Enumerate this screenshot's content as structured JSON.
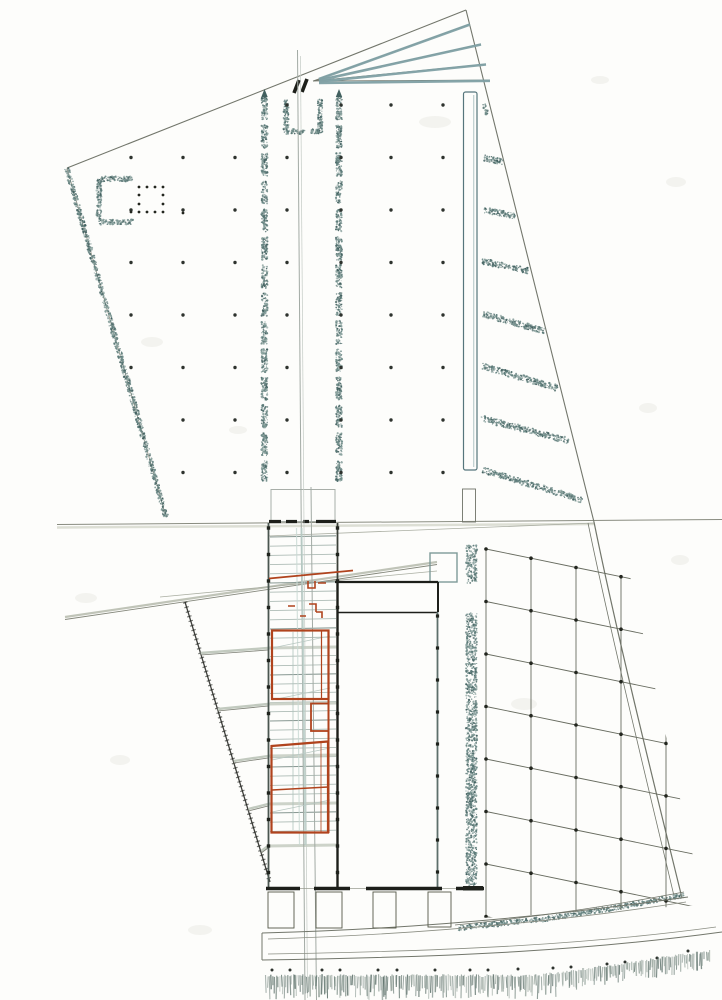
{
  "document": {
    "type": "scanned architectural site plan drawing",
    "description": "Hand-drafted master plan: upper trapezoidal plaza with column grid and twin tree rows, entry fan at top, central stair-ramp spine with red-outlined building rooms, dark exhibition hall, curvilinear orchard grid at lower right, waterfront promenade with reed fringe at bottom",
    "visible_text": []
  },
  "palette": {
    "paper": "#fdfdfb",
    "ink": "#72766b",
    "black": "#1d1f1a",
    "teal_dark": "#42605f",
    "teal_mid": "#6f8c89",
    "teal_light": "#9db7b7",
    "brick_red": "#b0431d",
    "road_gray": "#c0c4b8",
    "rung_light": "#aebcb6",
    "rung_dark": "#8a9a94",
    "fringe_green": "#70827c",
    "blotch": "#ebebe5"
  },
  "drawing": {
    "canvas": {
      "w": 722,
      "h": 1000
    },
    "stipple_colors": [
      "#42605f",
      "#597876",
      "#6f8c89",
      "#8da4a0"
    ],
    "stipple_strips": [
      {
        "name": "boundary-left-hatch",
        "x1": 67,
        "y1": 168,
        "x2": 166,
        "y2": 517,
        "w": 5,
        "d": 0.5,
        "seg": 0,
        "gap": 0
      },
      {
        "name": "tree-row-left",
        "x1": 264.5,
        "y1": 97,
        "x2": 264.5,
        "y2": 481,
        "w": 6,
        "d": 0.55,
        "seg": 23,
        "gap": 5
      },
      {
        "name": "tree-row-right",
        "x1": 339,
        "y1": 97,
        "x2": 339,
        "y2": 481,
        "w": 6,
        "d": 0.55,
        "seg": 23,
        "gap": 5
      },
      {
        "name": "gate-left-post",
        "x1": 286,
        "y1": 99,
        "x2": 286,
        "y2": 133,
        "w": 5,
        "d": 0.6,
        "seg": 0,
        "gap": 0
      },
      {
        "name": "gate-left-foot",
        "x1": 286,
        "y1": 131.5,
        "x2": 305,
        "y2": 131.5,
        "w": 5,
        "d": 0.6,
        "seg": 0,
        "gap": 0
      },
      {
        "name": "gate-right-post",
        "x1": 320,
        "y1": 99,
        "x2": 320,
        "y2": 133,
        "w": 5,
        "d": 0.6,
        "seg": 0,
        "gap": 0
      },
      {
        "name": "gate-right-foot",
        "x1": 311,
        "y1": 131.5,
        "x2": 320,
        "y2": 131.5,
        "w": 5,
        "d": 0.6,
        "seg": 0,
        "gap": 0
      },
      {
        "name": "c-pavilion-top",
        "x1": 99,
        "y1": 179,
        "x2": 133,
        "y2": 179,
        "w": 5,
        "d": 0.6,
        "seg": 0,
        "gap": 0
      },
      {
        "name": "c-pavilion-left",
        "x1": 99,
        "y1": 179,
        "x2": 99,
        "y2": 222,
        "w": 5,
        "d": 0.6,
        "seg": 0,
        "gap": 0
      },
      {
        "name": "c-pavilion-bottom",
        "x1": 99,
        "y1": 222,
        "x2": 133,
        "y2": 222,
        "w": 5,
        "d": 0.6,
        "seg": 0,
        "gap": 0
      },
      {
        "name": "service-strip-upper",
        "x1": 471.5,
        "y1": 545,
        "x2": 471.5,
        "y2": 583,
        "w": 11,
        "d": 0.4,
        "seg": 0,
        "gap": 0
      },
      {
        "name": "service-strip-lower",
        "x1": 471.5,
        "y1": 613,
        "x2": 471.5,
        "y2": 886,
        "w": 11,
        "d": 0.4,
        "seg": 0,
        "gap": 0
      },
      {
        "name": "sweep-band-1",
        "x1": 458,
        "y1": 928,
        "x2": 545,
        "y2": 919,
        "w": 5,
        "d": 0.5,
        "seg": 0,
        "gap": 0
      },
      {
        "name": "sweep-band-2",
        "x1": 545,
        "y1": 919,
        "x2": 620,
        "y2": 907,
        "w": 5,
        "d": 0.5,
        "seg": 0,
        "gap": 0
      },
      {
        "name": "sweep-band-3",
        "x1": 620,
        "y1": 907,
        "x2": 684,
        "y2": 895,
        "w": 5,
        "d": 0.5,
        "seg": 0,
        "gap": 0
      },
      {
        "name": "hedge-mini",
        "x1": 484,
        "y1": 104,
        "x2": 487,
        "y2": 114,
        "w": 3,
        "d": 0.7,
        "seg": 0,
        "gap": 0
      }
    ],
    "hedge_bars": [
      [
        484,
        158,
        503,
        162
      ],
      [
        484,
        210,
        515,
        216
      ],
      [
        482,
        261,
        529,
        271
      ],
      [
        483,
        314,
        544,
        331
      ],
      [
        482,
        366,
        557,
        388
      ],
      [
        481,
        418,
        569,
        441
      ],
      [
        483,
        470,
        582,
        500
      ]
    ],
    "hedge_bar_w": 6,
    "column_grid": {
      "cols": [
        131,
        183,
        235,
        287,
        341,
        391,
        443
      ],
      "rows": [
        105,
        157.5,
        210,
        262.5,
        315,
        367.5,
        420,
        472.5
      ],
      "skip": [
        "131,105",
        "183,105",
        "235,105",
        "131,420",
        "131,472.5"
      ],
      "r": 1.7
    },
    "pavilion_dots": {
      "xs": [
        139,
        147,
        155,
        163
      ],
      "ys": [
        187,
        195,
        204,
        212
      ],
      "omit_inner": true,
      "extra": [
        [
          131,
          212
        ],
        [
          183,
          213
        ]
      ],
      "r": 1.4
    },
    "band": {
      "x1": 270,
      "x2": 336,
      "rung_y1": 537,
      "rung_y2": 836,
      "step": 9.2,
      "dark_every": 5
    },
    "cross_bands": [
      648,
      704,
      756,
      804,
      846
    ],
    "rays": {
      "band_x": 268,
      "ys": [
        648,
        704,
        756,
        804,
        846
      ],
      "edge_x0": 185,
      "edge_y0": 602,
      "edge_slope": 0.306,
      "drop": 5
    },
    "wall_ticks": [
      {
        "xs": [
          268.5,
          337.5
        ],
        "y0": 528,
        "step": 26.5,
        "n": 14,
        "s": 3.4
      },
      {
        "xs": [
          437.5
        ],
        "y0": 616,
        "step": 32,
        "n": 9,
        "s": 3.2
      }
    ],
    "top_dashes": {
      "y": 521.5,
      "segs": [
        [
          269,
          281
        ],
        [
          286,
          297
        ],
        [
          303,
          309
        ],
        [
          316,
          336
        ]
      ],
      "w": 3.2
    },
    "bottom_wall": {
      "y": 888.5,
      "segs": [
        [
          266,
          300
        ],
        [
          314,
          350
        ],
        [
          366,
          442
        ],
        [
          456,
          484
        ]
      ],
      "w": 3.6,
      "thin": [
        266,
        484
      ]
    },
    "stalls": [
      [
        268,
        892,
        26,
        36
      ],
      [
        316,
        892,
        26,
        36
      ],
      [
        373,
        892,
        23,
        36
      ],
      [
        428,
        892,
        23,
        35
      ]
    ],
    "orchard": {
      "x0": 486,
      "y0": 549,
      "dx": 45,
      "dy": 52.5,
      "row_slope": 0.205,
      "cols": 6,
      "rows": 8,
      "dot_r": 1.8,
      "clip": "481,543 630,576 704,905 481,918"
    },
    "bottom_dots": [
      [
        272,
        970
      ],
      [
        290,
        970
      ],
      [
        322,
        970
      ],
      [
        340,
        970
      ],
      [
        378,
        970
      ],
      [
        397,
        970
      ],
      [
        435,
        970
      ],
      [
        470,
        970
      ],
      [
        488,
        970
      ],
      [
        518,
        969
      ],
      [
        553,
        968
      ],
      [
        571,
        967
      ],
      [
        607,
        964
      ],
      [
        625,
        962
      ],
      [
        657,
        958
      ],
      [
        688,
        951
      ]
    ],
    "fringe": {
      "x1": 266,
      "x2": 710,
      "step": 1.7,
      "base_y": 974,
      "bend_x": 540,
      "bend_slope": 0.145
    },
    "blotches": [
      [
        435,
        122,
        16,
        6
      ],
      [
        152,
        342,
        11,
        5
      ],
      [
        238,
        430,
        9,
        4
      ],
      [
        524,
        704,
        13,
        6
      ],
      [
        648,
        408,
        9,
        5
      ],
      [
        86,
        598,
        11,
        5
      ],
      [
        676,
        182,
        10,
        5
      ],
      [
        600,
        80,
        9,
        4
      ],
      [
        120,
        760,
        10,
        5
      ],
      [
        680,
        560,
        9,
        5
      ],
      [
        200,
        930,
        12,
        5
      ]
    ]
  }
}
